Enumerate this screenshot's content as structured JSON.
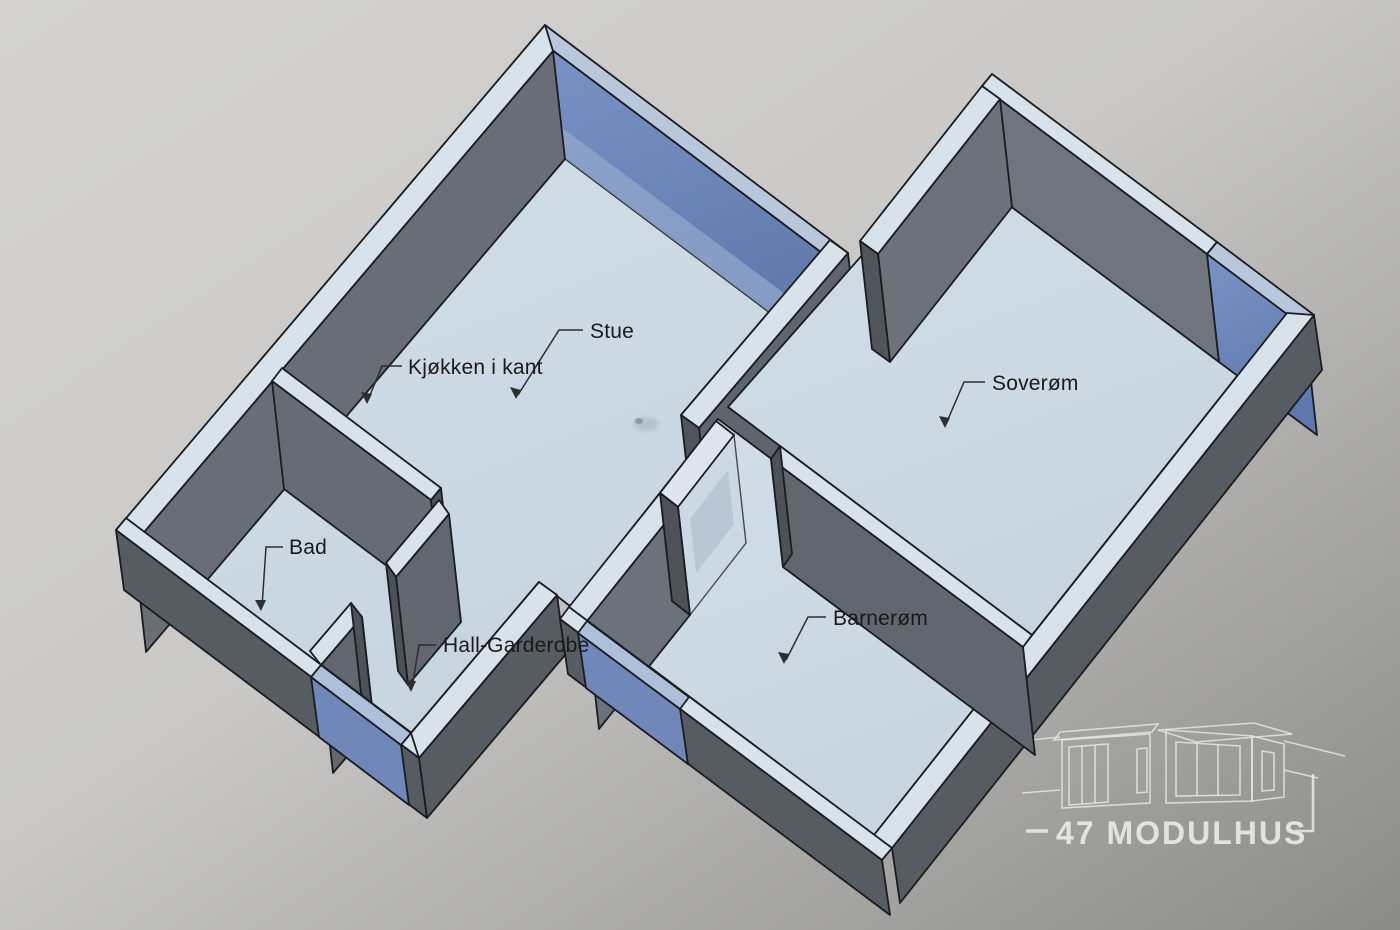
{
  "scene": {
    "type": "3d-floorplan-perspective",
    "style": "CAD bird's-eye cutaway view of a modular house"
  },
  "labels": {
    "stue": "Stue",
    "kjokken": "Kjøkken i kant",
    "soverom": "Soverøm",
    "bad": "Bad",
    "hall": "Hall-Garderobe",
    "barnerom": "Barnerøm"
  },
  "logo": {
    "brand": "47 MODULHUS"
  },
  "colors": {
    "window_blue": "#6f88bb",
    "window_blue_top": "#b4c3db",
    "wall_interior_gray": "#6c717a",
    "wall_exterior_gray": "#575b62",
    "wall_end_cap": "#50545b",
    "wall_top": "#d8e2ea",
    "floor": "#cdd9e3",
    "glass_partition": "#ccd9e5",
    "background_light": "#d2d1cf",
    "background_dark": "#8d8d8b",
    "label_text": "#1a1a1a",
    "logo_text": "#e9eae8"
  }
}
